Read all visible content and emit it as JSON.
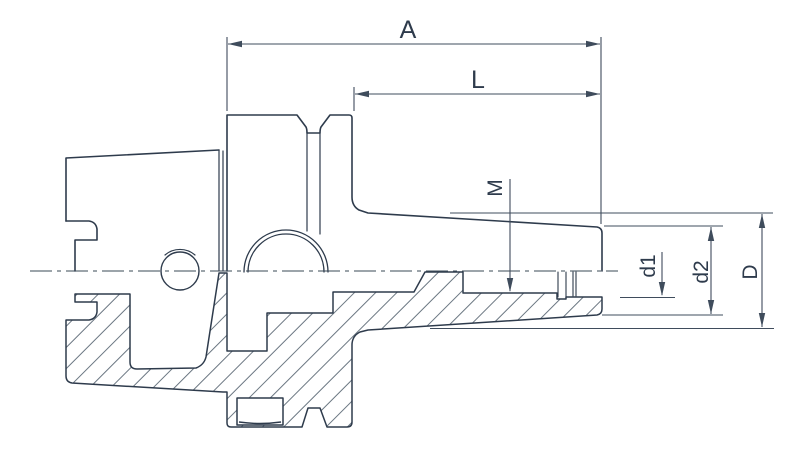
{
  "drawing": {
    "type": "engineering-section-drawing",
    "subject": "shrink-fit tool holder with hollow taper shank, flange and tapered nose, lower half shown in section with hatching",
    "labels": {
      "a": "A",
      "l": "L",
      "m": "M",
      "d1": "d1",
      "d2": "d2",
      "d": "D"
    },
    "dimensions": [
      {
        "label": "A",
        "meaning": "overall length",
        "orientation": "horizontal"
      },
      {
        "label": "L",
        "meaning": "projection length from flange",
        "orientation": "horizontal"
      },
      {
        "label": "M",
        "meaning": "internal thread, leader into bore",
        "orientation": "vertical-leader"
      },
      {
        "label": "d1",
        "meaning": "clamping bore diameter",
        "orientation": "vertical"
      },
      {
        "label": "d2",
        "meaning": "nose end diameter",
        "orientation": "vertical"
      },
      {
        "label": "D",
        "meaning": "taper large-end diameter",
        "orientation": "vertical"
      }
    ],
    "colors": {
      "outline": "#2e3b4c",
      "dimension_lines": "#3f4c5c",
      "hatching": "#5a6774",
      "background": "#ffffff"
    }
  }
}
